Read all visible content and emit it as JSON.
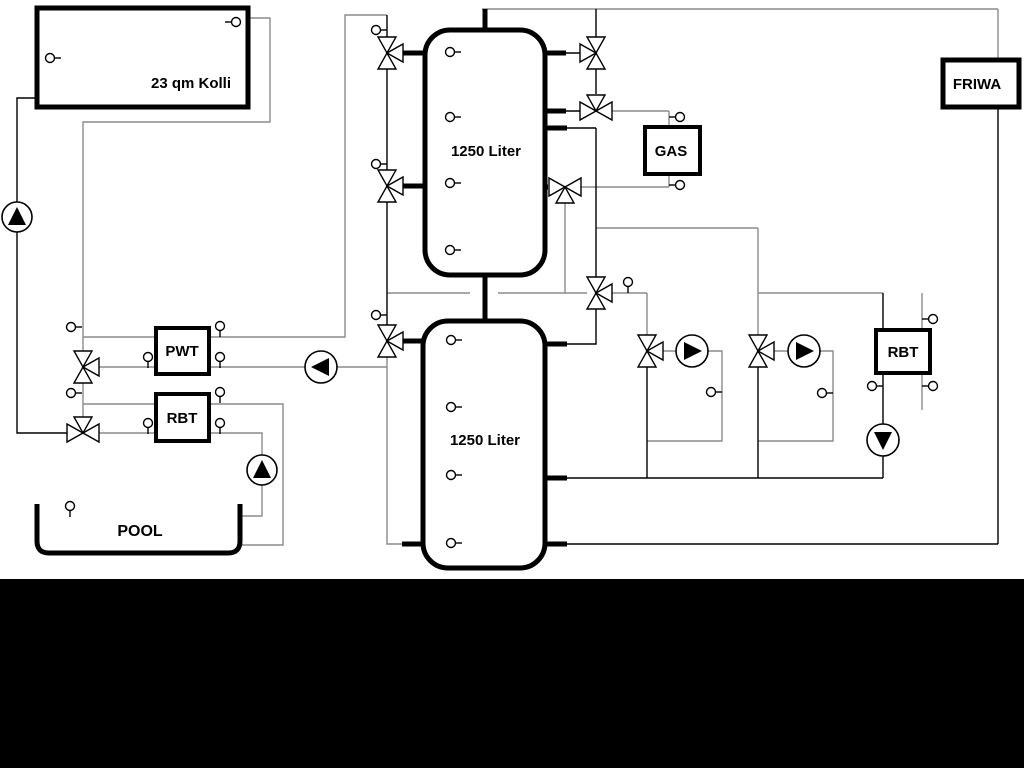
{
  "diagram": {
    "labels": {
      "collector": "23 qm Kolli",
      "tank_top": "1250 Liter",
      "tank_bottom": "1250 Liter",
      "pwt": "PWT",
      "rbt_left": "RBT",
      "rbt_right": "RBT",
      "gas": "GAS",
      "friwa": "FRIWA",
      "pool": "POOL"
    },
    "colors": {
      "line": "#000000",
      "line_soft": "#8c8c8c",
      "background": "#ffffff",
      "band": "#000000",
      "text": "#000000"
    }
  }
}
